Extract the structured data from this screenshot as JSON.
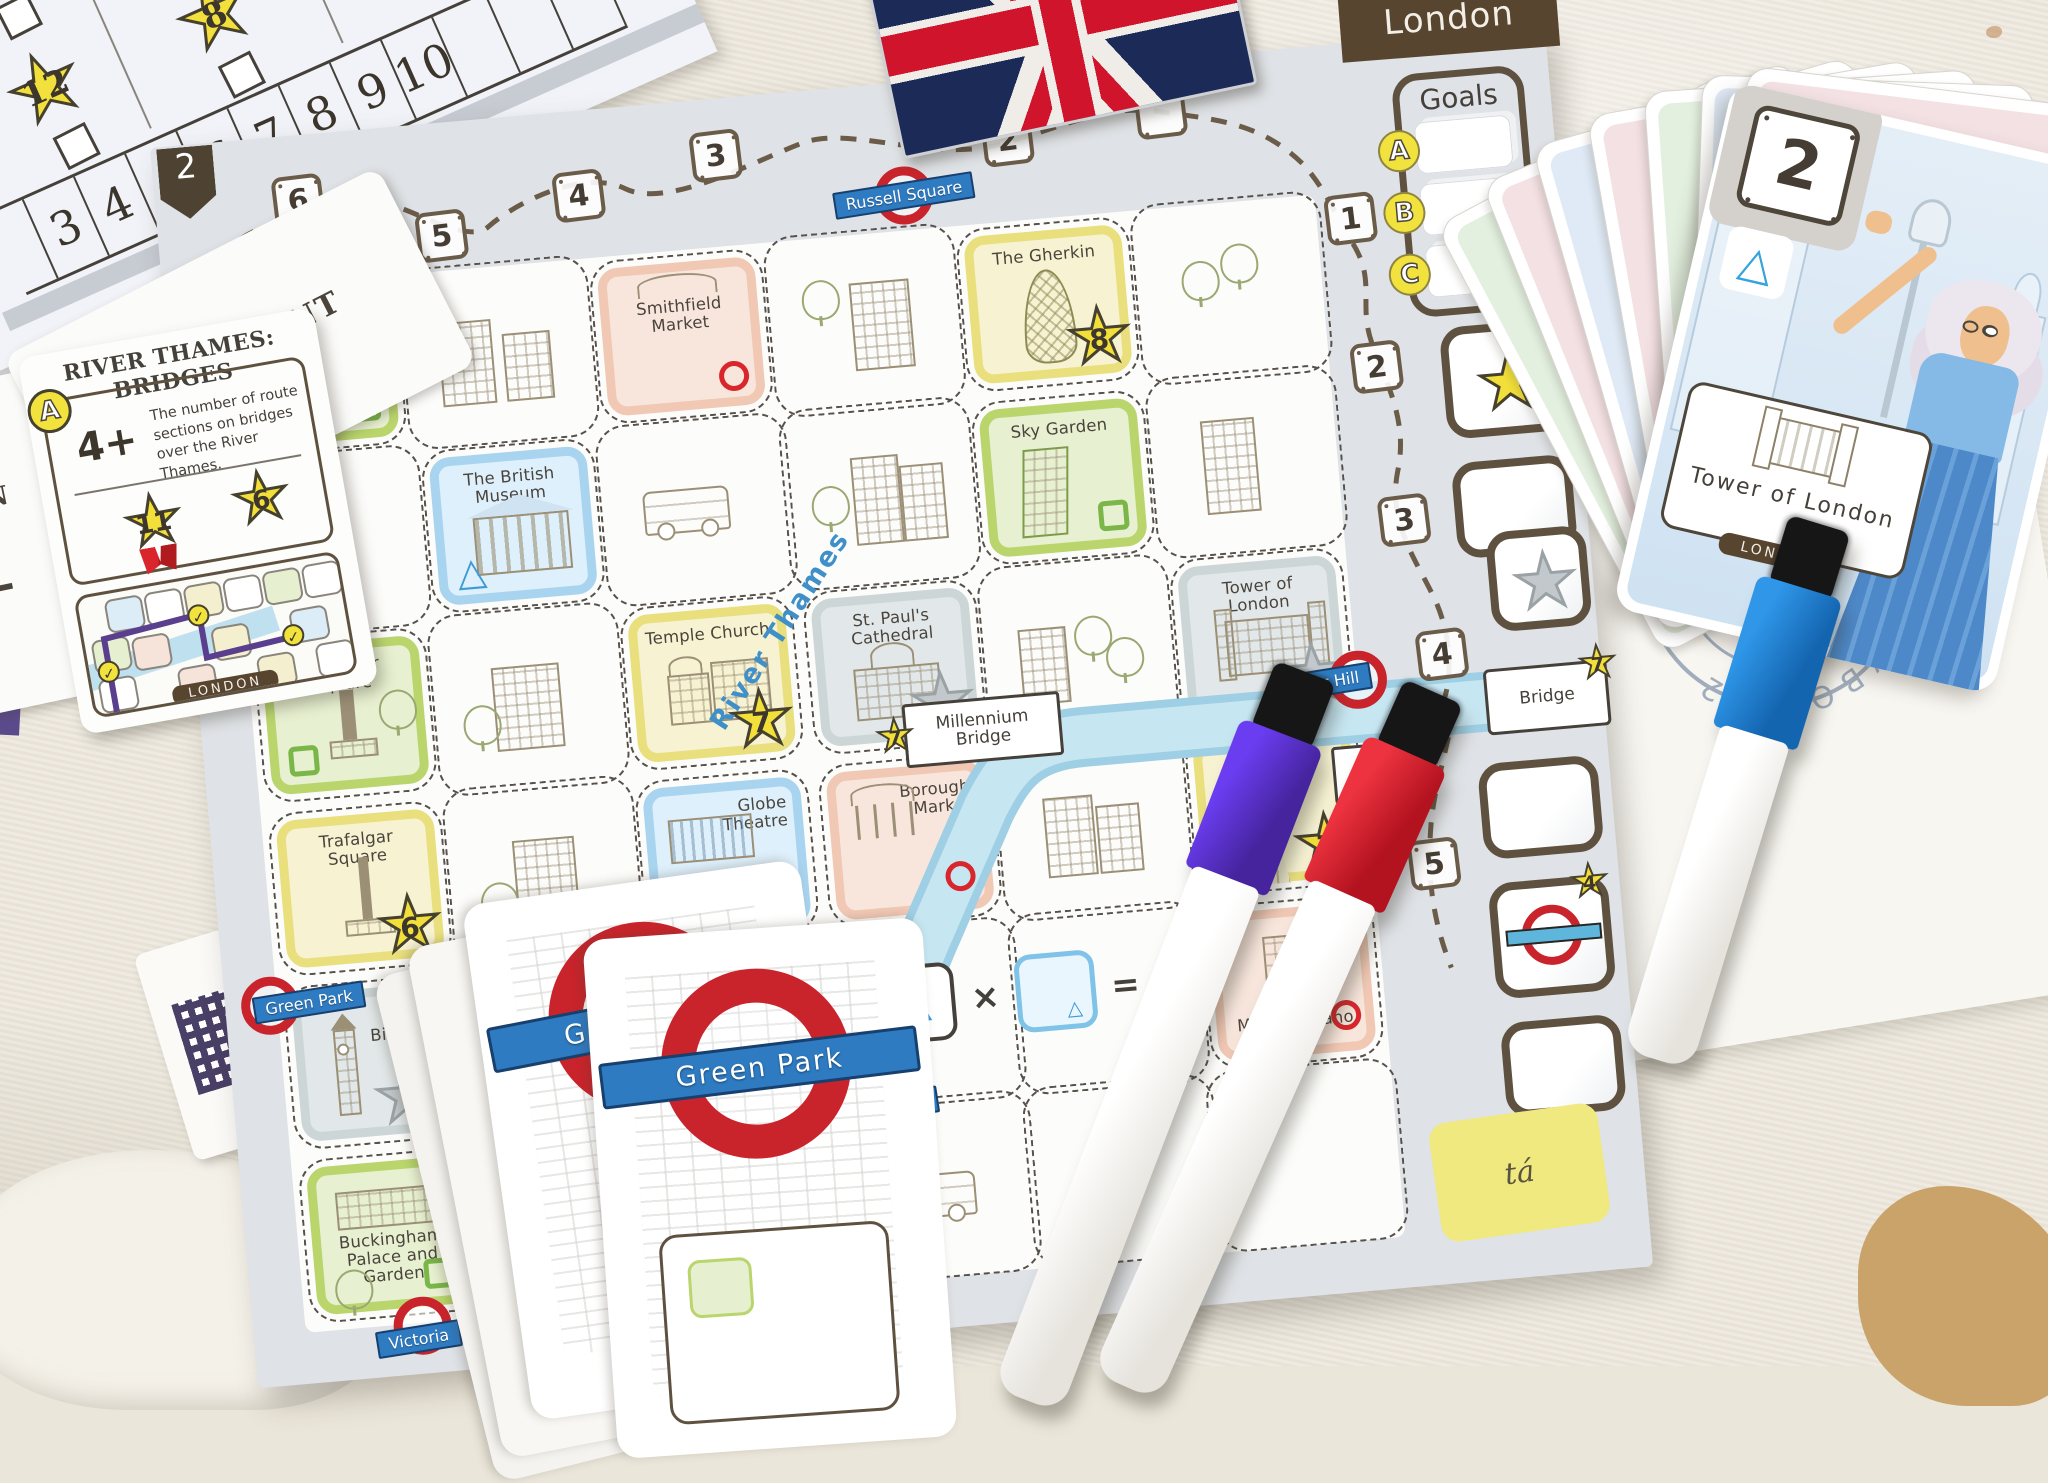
{
  "colors": {
    "board_margin": "#dfe2e6",
    "map": "#fcfcfa",
    "outline_brown": "#5f5140",
    "river": "#aedbea",
    "star_yellow": "#f2df3a",
    "star_gray": "#c2c8cb",
    "circle_red": "#d8262c",
    "square_green": "#7ab648",
    "triangle_blue": "#3d9bd6",
    "roundel_red": "#c9242b",
    "station_blue": "#2e7bc2",
    "cell_yellow": "#e9df7d",
    "cell_green": "#b9d56c",
    "cell_blue": "#a9d4ef",
    "cell_pink": "#f0c8b4",
    "pen_purple": "#4b2bd0",
    "pen_red": "#d01f2c",
    "pen_blue": "#1f7fd6"
  },
  "scoresheet": {
    "star_a": "6",
    "star_b": "12",
    "star_c": "8",
    "numbers": [
      "3",
      "4",
      "5",
      "6",
      "7",
      "8",
      "9",
      "10"
    ]
  },
  "side_cards": {
    "waterfront": "WATERFRONT",
    "fragment_letters": "IAN",
    "fragment_number": "5-"
  },
  "bridges_card": {
    "title": "RIVER THAMES: BRIDGES",
    "badge": "A",
    "threshold": "4+",
    "description": "The number of route sections on bridges over the River Thames.",
    "star_major": "11",
    "star_minor": "6",
    "check": "✓",
    "footer": "LONDON"
  },
  "board": {
    "corner_number": "2",
    "city_tab": "London",
    "goals_title": "Goals",
    "goal_letters": [
      "A",
      "B",
      "C"
    ],
    "top_path": [
      "6",
      "5",
      "4",
      "3",
      "2"
    ],
    "right_path": [
      "1",
      "2",
      "3",
      "4",
      "5"
    ],
    "river_label": "River Thames",
    "stations": {
      "russell_square": "Russell Square",
      "tower_hill": "Tower Hill",
      "green_park": "Green Park",
      "waterloo": "Waterloo",
      "victoria": "Victoria"
    },
    "bridges": {
      "millennium_l1": "Millennium",
      "millennium_l2": "Bridge",
      "millennium_star": "7",
      "tower_l1": "Tower",
      "tower_l2": "Bridge",
      "tower_star": "7",
      "lambeth_l1": "Lambeth",
      "lambeth_l2": "Bridge"
    },
    "goal_boxes": {
      "bridge_label": "Bridge",
      "bridge_star": "7",
      "station_star": "4",
      "corner_fragment": "tá"
    },
    "formula": {
      "times": "×",
      "equals": "="
    },
    "cells": {
      "regents_park": {
        "name": "Regent's Park"
      },
      "smithfield_market": {
        "name": "Smithfield Market"
      },
      "the_gherkin": {
        "name": "The Gherkin",
        "star": "8"
      },
      "british_museum": {
        "name": "The British Museum"
      },
      "sky_garden": {
        "name": "Sky Garden"
      },
      "leicester_square": {
        "name": "Leicester Square"
      },
      "temple_church": {
        "name": "Temple Church",
        "star": "7"
      },
      "st_pauls": {
        "name": "St. Paul's Cathedral"
      },
      "tower_of_london": {
        "name": "Tower of London"
      },
      "trafalgar_square": {
        "name": "Trafalgar Square",
        "star": "6"
      },
      "globe_theatre": {
        "name": "Globe Theatre"
      },
      "borough_market": {
        "name": "Borough Market"
      },
      "the_shard": {
        "name": "The Shard",
        "star": "7"
      },
      "big_ben": {
        "name": "Big Ben"
      },
      "london_eye": {
        "name": "London Eye"
      },
      "mercato": {
        "name": "Mercato Metropolitano"
      },
      "buckingham": {
        "name": "Buckingham Palace and Garden"
      },
      "westminster_abbey": {
        "name": "Westminster Abbey"
      },
      "imperial_war": {
        "name": "Imperial War Museum"
      }
    }
  },
  "fan_card": {
    "number": "2",
    "landmark": "Tower of London",
    "ribbon": "LONDON"
  },
  "station_cards": {
    "front": "Green Park",
    "back": "Green Park"
  },
  "stamp_text": "ЛУ ВЫКУВО 102"
}
